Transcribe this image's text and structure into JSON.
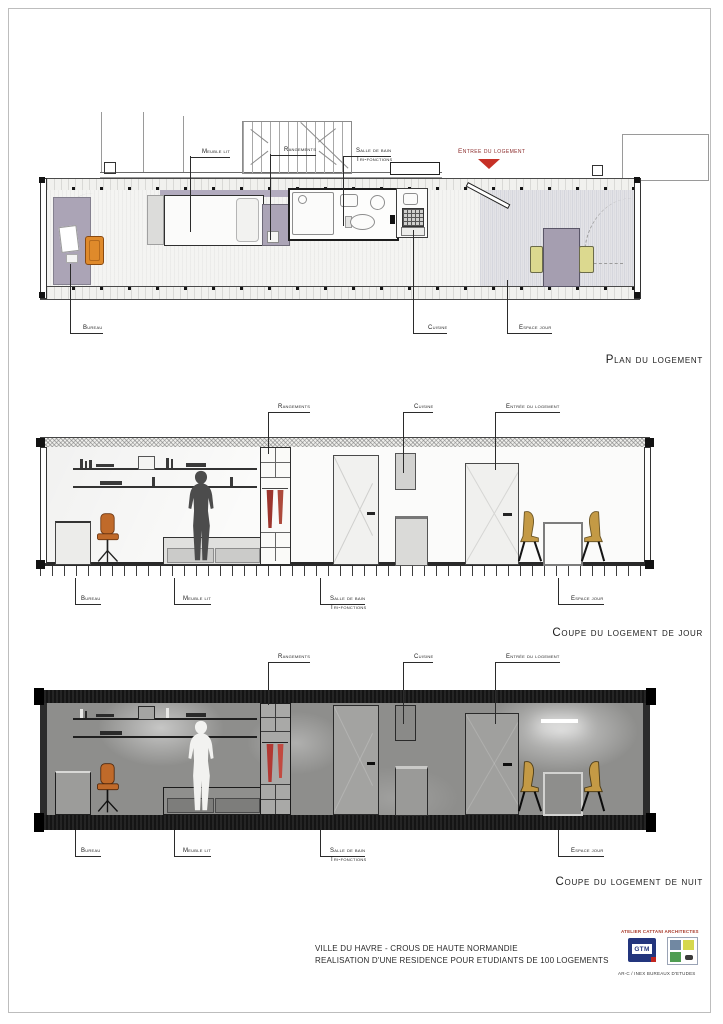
{
  "palette": {
    "accent_red": "#c63026",
    "entry_text_red": "#8b2a2a",
    "furniture_purple": "#aba4b6",
    "plan_chair_orange": "#df8a2b",
    "section_chair_orange": "#c06a2a",
    "dining_chair_tan": "#c49a45",
    "plan_chair_green": "#dcd98f",
    "clothes_red": "#9c352d",
    "night_black": "#141414",
    "line_dark": "#2b2b2b"
  },
  "plan": {
    "title": "Plan du logement",
    "labels": {
      "meuble_lit": "Meuble lit",
      "rangements": "Rangements",
      "salle_de_bain": "Salle de bain",
      "tri_fonctions": "Tri-fonctions",
      "entree": "Entree du logement",
      "bureau": "Bureau",
      "cuisine": "Cuisine",
      "espace_jour": "Espace jour"
    }
  },
  "coupe_jour": {
    "title": "Coupe du logement de jour",
    "labels": {
      "rangements": "Rangements",
      "cuisine": "Cuisine",
      "entree": "Entrée du logement",
      "bureau": "Bureau",
      "meuble_lit": "Meuble lit",
      "salle_de_bain": "Salle de bain",
      "tri_fonctions": "Tri-fonctions",
      "espace_jour": "Espace jour"
    }
  },
  "coupe_nuit": {
    "title": "Coupe du logement de nuit",
    "labels": {
      "rangements": "Rangements",
      "cuisine": "Cuisine",
      "entree": "Entrée du logement",
      "bureau": "Bureau",
      "meuble_lit": "Meuble lit",
      "salle_de_bain": "Salle de bain",
      "tri_fonctions": "Tri-fonctions",
      "espace_jour": "Espace jour"
    }
  },
  "footer": {
    "project_line1": "VILLE DU HAVRE - CROUS DE HAUTE NORMANDIE",
    "project_line2": "REALISATION D'UNE RESIDENCE POUR ETUDIANTS DE 100 LOGEMENTS",
    "credits": {
      "architect": "ATELIER CATTANI ARCHITECTES",
      "gtm": "GTM",
      "bureaux": "AR-C / INEX  BUREAUX D'ETUDES"
    }
  }
}
